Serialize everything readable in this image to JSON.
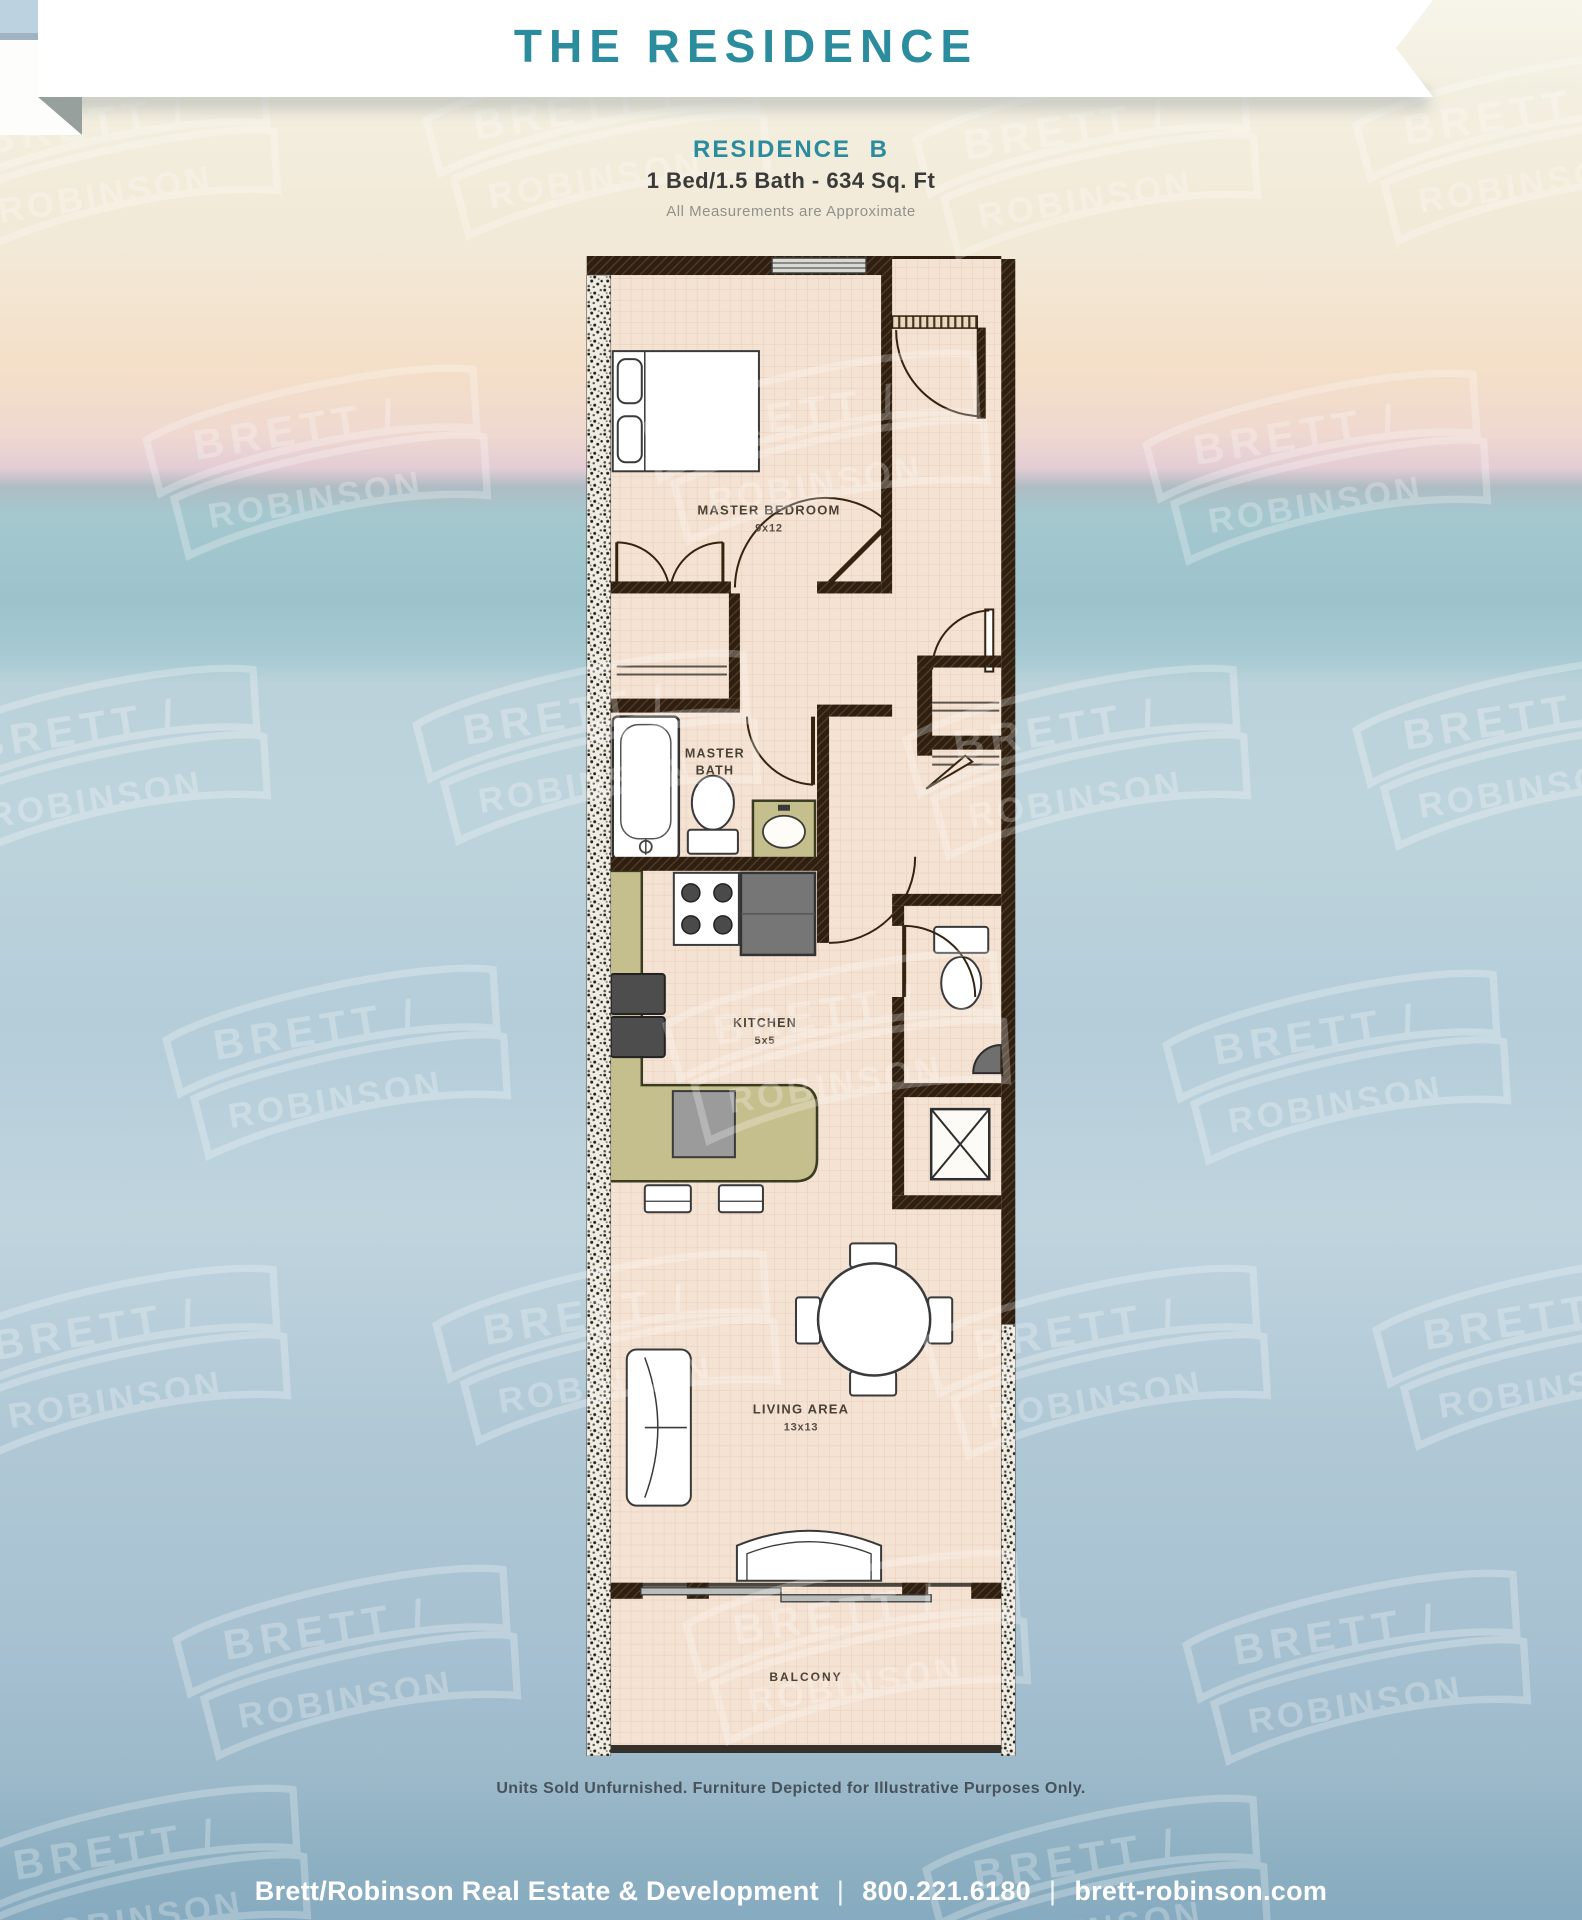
{
  "banner": {
    "title": "THE RESIDENCE"
  },
  "header": {
    "residence_label": "RESIDENCE B",
    "specs": "1 Bed/1.5 Bath - 634 Sq. Ft",
    "note": "All Measurements are Approximate"
  },
  "floor_plan": {
    "master_bedroom_name": "MASTER BEDROOM",
    "master_bedroom_dims": "9x12",
    "master_bath_line1": "MASTER",
    "master_bath_line2": "BATH",
    "kitchen_name": "KITCHEN",
    "kitchen_dims": "5x5",
    "living_name": "LIVING AREA",
    "living_dims": "13x13",
    "balcony_name": "BALCONY"
  },
  "watermark": {
    "line1": "BRETT /",
    "line2": "ROBINSON"
  },
  "disclaimer": "Units Sold Unfurnished. Furniture Depicted for Illustrative Purposes Only.",
  "footer": {
    "company": "Brett/Robinson Real Estate & Development",
    "phone": "800.221.6180",
    "website": "brett-robinson.com",
    "separator": "|"
  },
  "colors": {
    "accent": "#2b8c9e",
    "wall": "#2e1f10",
    "floor": "#f4e2d3",
    "counter": "#c5bf8d"
  }
}
